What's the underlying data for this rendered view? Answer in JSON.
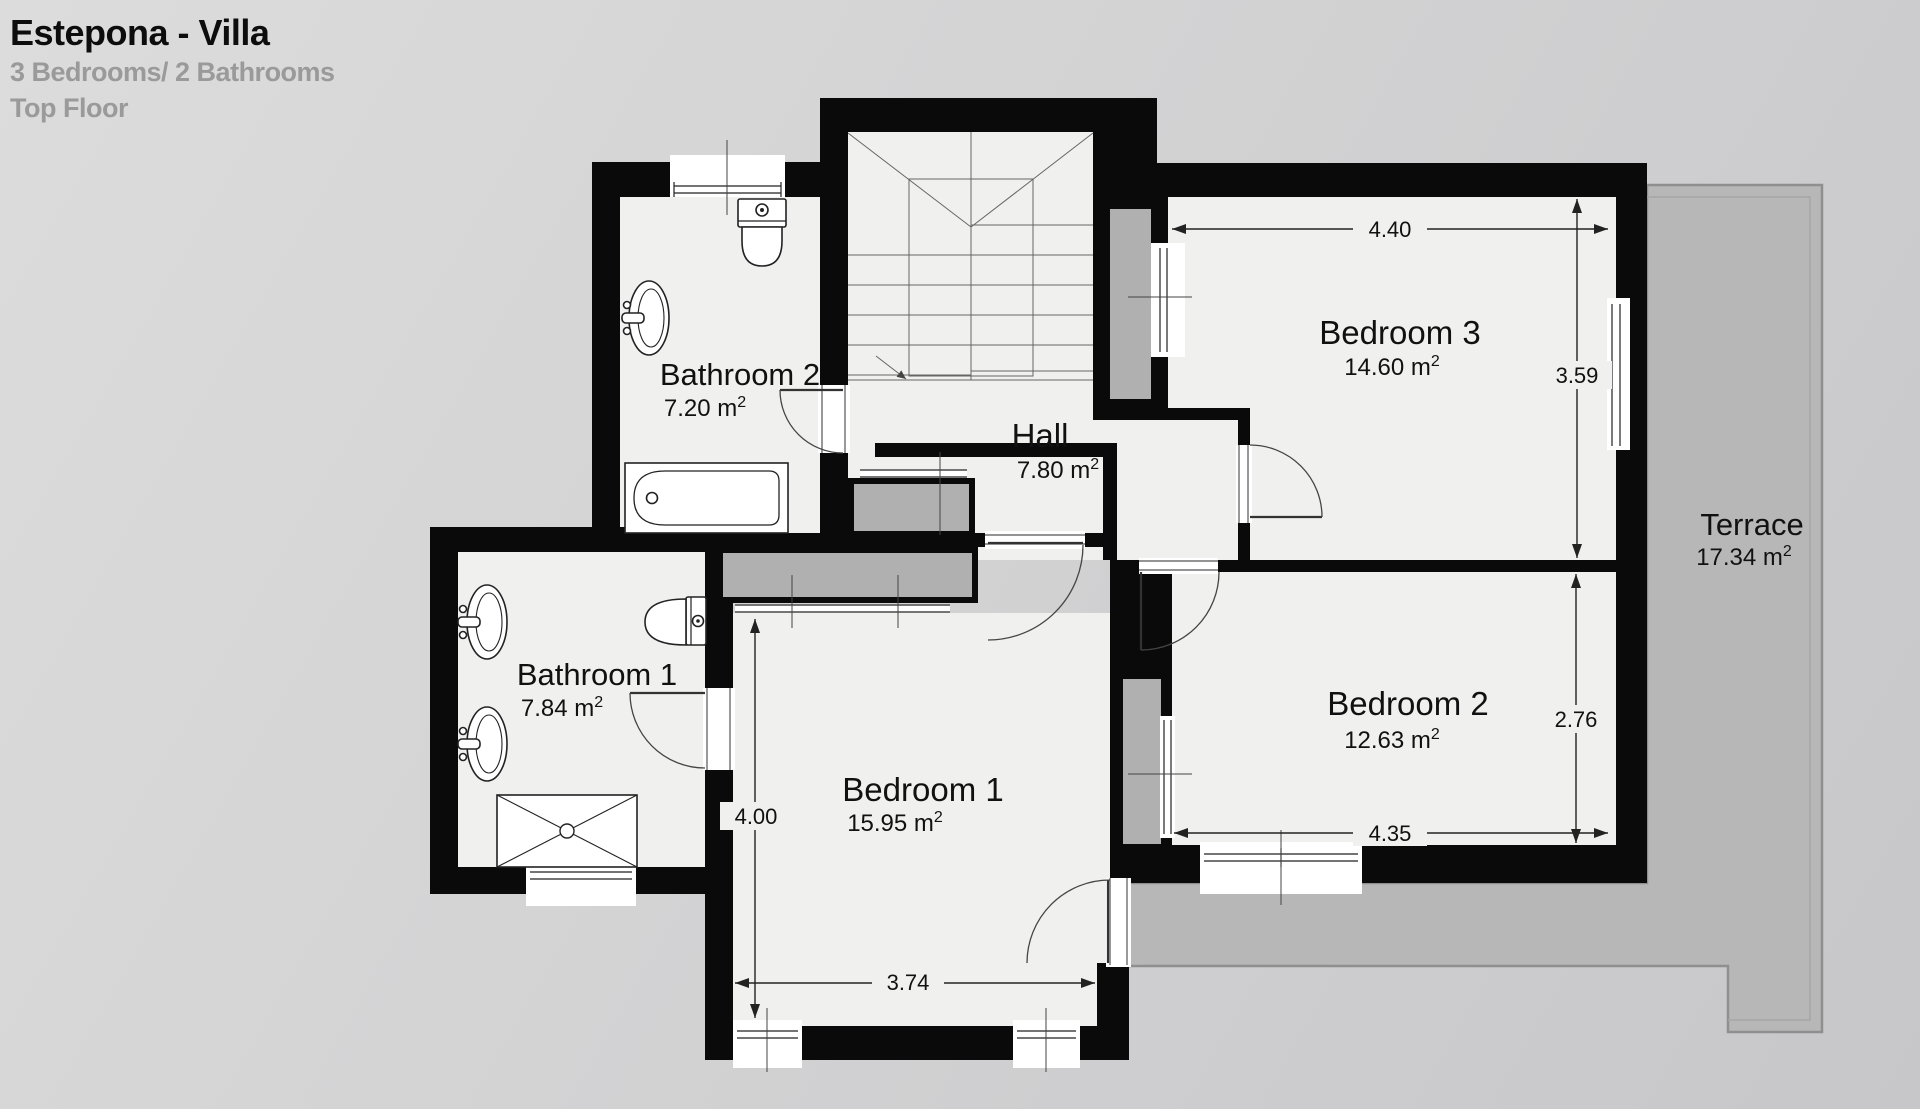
{
  "header": {
    "title": "Estepona - Villa",
    "subtitle": "3 Bedrooms/ 2 Bathrooms",
    "floor_label": "Top Floor"
  },
  "rooms": {
    "bathroom2": {
      "name": "Bathroom 2",
      "area": "7.20 m",
      "area_sup": "2"
    },
    "bathroom1": {
      "name": "Bathroom 1",
      "area": "7.84 m",
      "area_sup": "2"
    },
    "hall": {
      "name": "Hall",
      "area": "7.80 m",
      "area_sup": "2"
    },
    "bedroom3": {
      "name": "Bedroom 3",
      "area": "14.60 m",
      "area_sup": "2"
    },
    "bedroom2": {
      "name": "Bedroom 2",
      "area": "12.63 m",
      "area_sup": "2"
    },
    "bedroom1": {
      "name": "Bedroom 1",
      "area": "15.95 m",
      "area_sup": "2"
    },
    "terrace": {
      "name": "Terrace",
      "area": "17.34 m",
      "area_sup": "2"
    }
  },
  "dimensions": {
    "bedroom3_width": "4.40",
    "bedroom3_depth": "3.59",
    "bedroom2_depth": "2.76",
    "bedroom2_width": "4.35",
    "bedroom1_depth": "4.00",
    "bedroom1_width": "3.74"
  },
  "colors": {
    "wall": "#0a0a0a",
    "floor": "#f0f0ef",
    "terrace_fill": "#b7b7b7",
    "terrace_border": "#8f8f8f",
    "closet_fill": "#b0b0b0",
    "background": "#d3d3d4",
    "dimension_line": "#222222",
    "muted_text": "#9a9a9a"
  }
}
